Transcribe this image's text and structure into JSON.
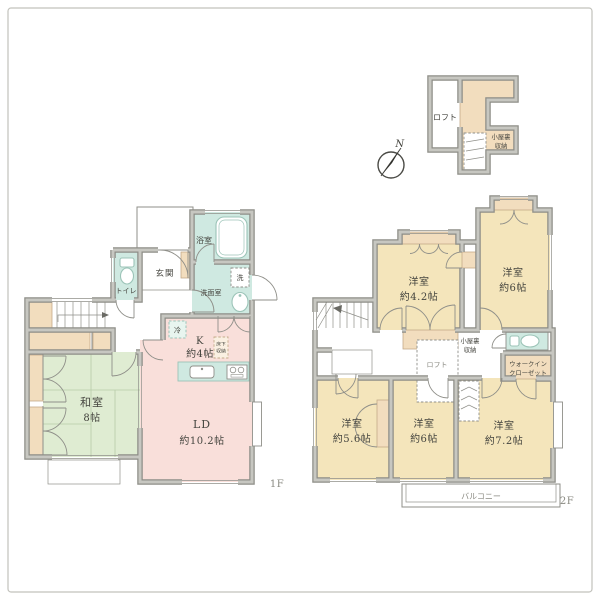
{
  "colors": {
    "wall_dark": "#8d8d87",
    "wall_light": "#c7c7c1",
    "line": "#8f8f89",
    "pink": "#f9dfda",
    "green": "#dfecd2",
    "green_line": "#b7cba8",
    "yellow": "#f4e5bb",
    "teal": "#cfe9e1",
    "teal_soft": "#e8f5ef",
    "teal_line": "#9cc4b8",
    "beige": "#f2ddbe",
    "beige_soft": "#faf0e2",
    "beige_line": "#c4ab89",
    "text": "#45453f",
    "text_light": "#8a8a82",
    "border": "#c2c2bc"
  },
  "compass": {
    "north": "N"
  },
  "floor1": {
    "label": "1F",
    "rooms": {
      "washitsu": {
        "name": "和室",
        "size": "8帖"
      },
      "ld": {
        "name": "LD",
        "size": "約10.2帖"
      },
      "kitchen": {
        "name": "K",
        "size": "約4帖"
      },
      "genkan": {
        "name": "玄関"
      },
      "toilet": {
        "name": "トイレ"
      },
      "bath": {
        "name": "浴室"
      },
      "senmen": {
        "name": "洗面室"
      }
    },
    "fixtures": {
      "washer": "洗",
      "fridge": "冷",
      "underfloor1": "床下",
      "underfloor2": "収納"
    }
  },
  "floor2": {
    "label": "2F",
    "rooms": {
      "bed1": {
        "name": "洋室",
        "size": "約4.2帖"
      },
      "bed2": {
        "name": "洋室",
        "size": "約6帖"
      },
      "bed3": {
        "name": "洋室",
        "size": "約5.6帖"
      },
      "bed4": {
        "name": "洋室",
        "size": "約6帖"
      },
      "bed5": {
        "name": "洋室",
        "size": "約7.2帖"
      },
      "wic1": "ウォークイン",
      "wic2": "クローゼット",
      "attic1": "小屋裏",
      "attic2": "収納",
      "loft": "ロフト",
      "balcony": "バルコニー"
    }
  },
  "loft_plan": {
    "loft": "ロフト",
    "attic1": "小屋裏",
    "attic2": "収納"
  }
}
